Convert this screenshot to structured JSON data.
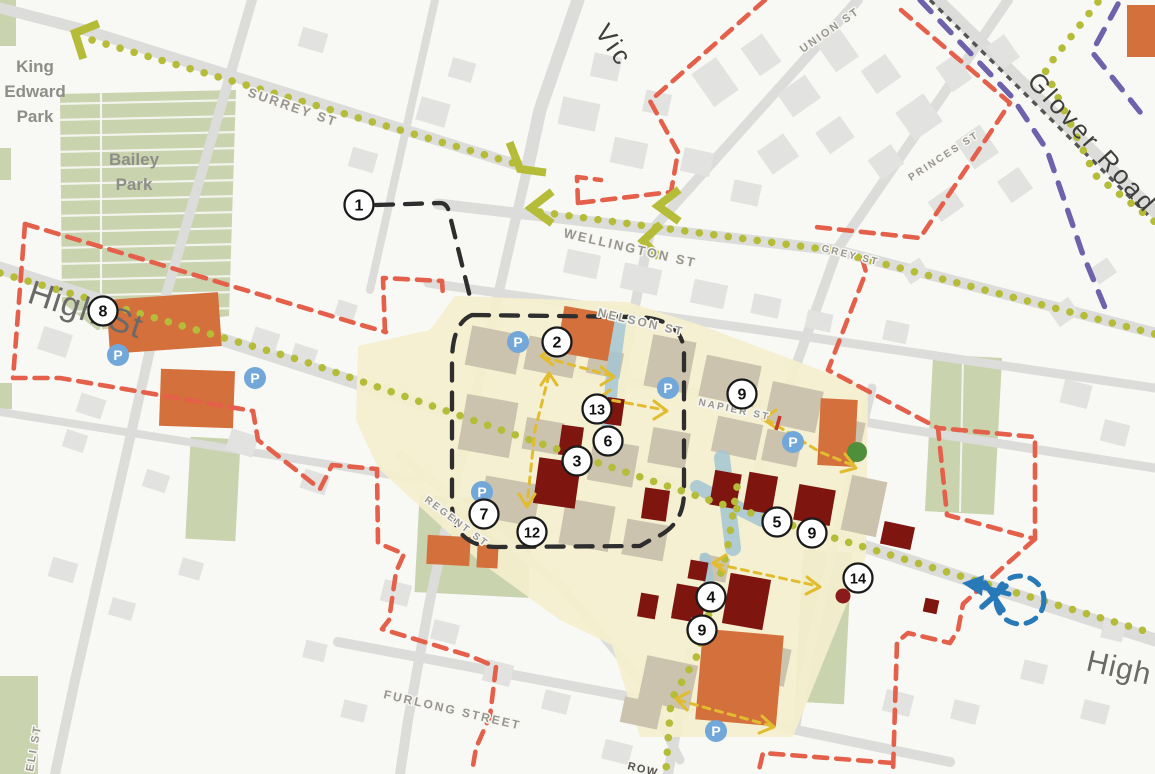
{
  "map": {
    "title": "Town centre framework map",
    "palette": {
      "route_green": "#b5bc37",
      "boundary_red": "#e4604a",
      "boundary_purple": "#6f62ad",
      "boundary_black": "#2e2e2e",
      "railway_gray": "#555555",
      "arrow_yellow": "#e2bc2f",
      "highlight_blue": "#2779b8",
      "parking_blue": "#72a7d9",
      "precinct_yellow": "#f4efcd",
      "building_orange": "#d4703c",
      "building_darkred": "#7e150f",
      "building_tan": "#cbc3ae",
      "building_gray": "#e2e2e0",
      "park_green": "#c9d3ae",
      "tree_green": "#4e8f3c",
      "water_blue": "#a5c6d4"
    },
    "area_labels": [
      {
        "id": "king-edward-park",
        "lines": [
          "King",
          "Edward",
          "Park"
        ],
        "x": 35,
        "y": 72,
        "line_height": 25,
        "size": 17
      },
      {
        "id": "bailey-park",
        "lines": [
          "Bailey",
          "Park"
        ],
        "x": 134,
        "y": 165,
        "line_height": 25,
        "size": 17
      }
    ],
    "street_labels": [
      {
        "id": "surrey-st",
        "text": "SURREY ST",
        "x": 247,
        "y": 96,
        "rotate": 19,
        "size": 13,
        "cls": "lbl-minor"
      },
      {
        "id": "wellington-st",
        "text": "WELLINGTON ST",
        "x": 563,
        "y": 237,
        "rotate": 13,
        "size": 13,
        "cls": "lbl-minor"
      },
      {
        "id": "nelson-st",
        "text": "NELSON ST",
        "x": 597,
        "y": 316,
        "rotate": 13,
        "size": 12,
        "cls": "lbl-minor"
      },
      {
        "id": "napier-st",
        "text": "NAPIER ST",
        "x": 698,
        "y": 405,
        "rotate": 12,
        "size": 10,
        "cls": "lbl-minor"
      },
      {
        "id": "grey-st",
        "text": "GREY ST",
        "x": 821,
        "y": 251,
        "rotate": 14,
        "size": 10,
        "cls": "lbl-minor"
      },
      {
        "id": "union-st",
        "text": "UNION ST",
        "x": 803,
        "y": 53,
        "rotate": -35,
        "size": 11,
        "cls": "lbl-minor"
      },
      {
        "id": "princes-st",
        "text": "PRINCES ST",
        "x": 911,
        "y": 181,
        "rotate": -33,
        "size": 10,
        "cls": "lbl-minor"
      },
      {
        "id": "furlong-street",
        "text": "FURLONG STREET",
        "x": 383,
        "y": 698,
        "rotate": 13,
        "size": 12,
        "cls": "lbl-minor"
      },
      {
        "id": "regent-st",
        "text": "REGENT ST",
        "x": 424,
        "y": 501,
        "rotate": 37,
        "size": 10,
        "cls": "lbl-minor"
      },
      {
        "id": "eli-st",
        "text": "ELI ST",
        "x": 33,
        "y": 772,
        "rotate": -80,
        "size": 11,
        "cls": "lbl-minor"
      },
      {
        "id": "row-street",
        "text": "ROW",
        "x": 627,
        "y": 769,
        "rotate": 14,
        "size": 11,
        "cls": "lbl-minor-dark"
      },
      {
        "id": "high-st-west",
        "text": "High St",
        "x": 26,
        "y": 302,
        "rotate": 18,
        "size": 34,
        "cls": "lbl-major"
      },
      {
        "id": "high-st-east",
        "text": "High S",
        "x": 1085,
        "y": 670,
        "rotate": 13,
        "size": 30,
        "cls": "lbl-major"
      },
      {
        "id": "glover-road",
        "text": "Glover Road",
        "x": 1026,
        "y": 82,
        "rotate": 48,
        "size": 26,
        "cls": "lbl-major-dark"
      },
      {
        "id": "victoria-st-partial",
        "text": "Vic",
        "x": 594,
        "y": 32,
        "rotate": 55,
        "size": 26,
        "cls": "lbl-major-dark"
      }
    ],
    "markers": [
      {
        "n": "1",
        "x": 359,
        "y": 205
      },
      {
        "n": "2",
        "x": 557,
        "y": 342
      },
      {
        "n": "13",
        "x": 597,
        "y": 409
      },
      {
        "n": "6",
        "x": 608,
        "y": 441
      },
      {
        "n": "3",
        "x": 577,
        "y": 461
      },
      {
        "n": "7",
        "x": 484,
        "y": 514
      },
      {
        "n": "12",
        "x": 532,
        "y": 532
      },
      {
        "n": "8",
        "x": 103,
        "y": 311
      },
      {
        "n": "9",
        "x": 742,
        "y": 394
      },
      {
        "n": "5",
        "x": 777,
        "y": 522
      },
      {
        "n": "9",
        "x": 812,
        "y": 533
      },
      {
        "n": "14",
        "x": 858,
        "y": 578
      },
      {
        "n": "4",
        "x": 711,
        "y": 597
      },
      {
        "n": "9",
        "x": 702,
        "y": 630
      }
    ],
    "parking_icons": [
      {
        "x": 118,
        "y": 355
      },
      {
        "x": 255,
        "y": 378
      },
      {
        "x": 518,
        "y": 342
      },
      {
        "x": 668,
        "y": 388
      },
      {
        "x": 482,
        "y": 492
      },
      {
        "x": 793,
        "y": 442
      },
      {
        "x": 716,
        "y": 731
      }
    ]
  }
}
